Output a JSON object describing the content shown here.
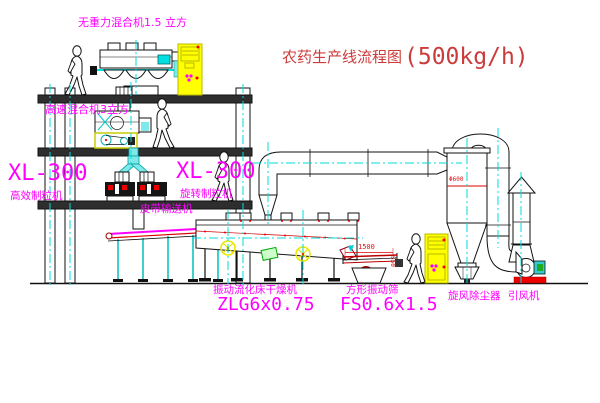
{
  "title": {
    "name": "农药生产线流程图",
    "capacity": "(500kg/h)"
  },
  "labels": {
    "gravity_mixer": "无重力混合机1.5 立方",
    "high_speed_mixer": "高速混合机3立方",
    "xl300_left": "XL-300",
    "granulator_left": "高效制粒机",
    "xl300_right": "XL-300",
    "granulator_right": "旋转制粒机",
    "belt_conveyor": "皮带输送机",
    "fluid_bed_dryer": "振动流化床干燥机",
    "fluid_bed_dryer_model": "ZLG6x0.75",
    "vibrating_screen": "方形振动筛",
    "vibrating_screen_model": "FS0.6x1.5",
    "cyclone": "旋风除尘器",
    "induced_draft_fan": "引风机"
  },
  "dimensions": {
    "screen_length": "1500",
    "screen_height": "550",
    "cyclone_note": "Φ600"
  },
  "colors": {
    "label_magenta": "#FF00FF",
    "title_red": "#CC3B3B",
    "dimension_red": "#DD1111",
    "centerline_cyan": "#00DDDD",
    "cabinet_yellow": "#FFFF00",
    "chute_cyan_fill": "#7FE8E8"
  }
}
